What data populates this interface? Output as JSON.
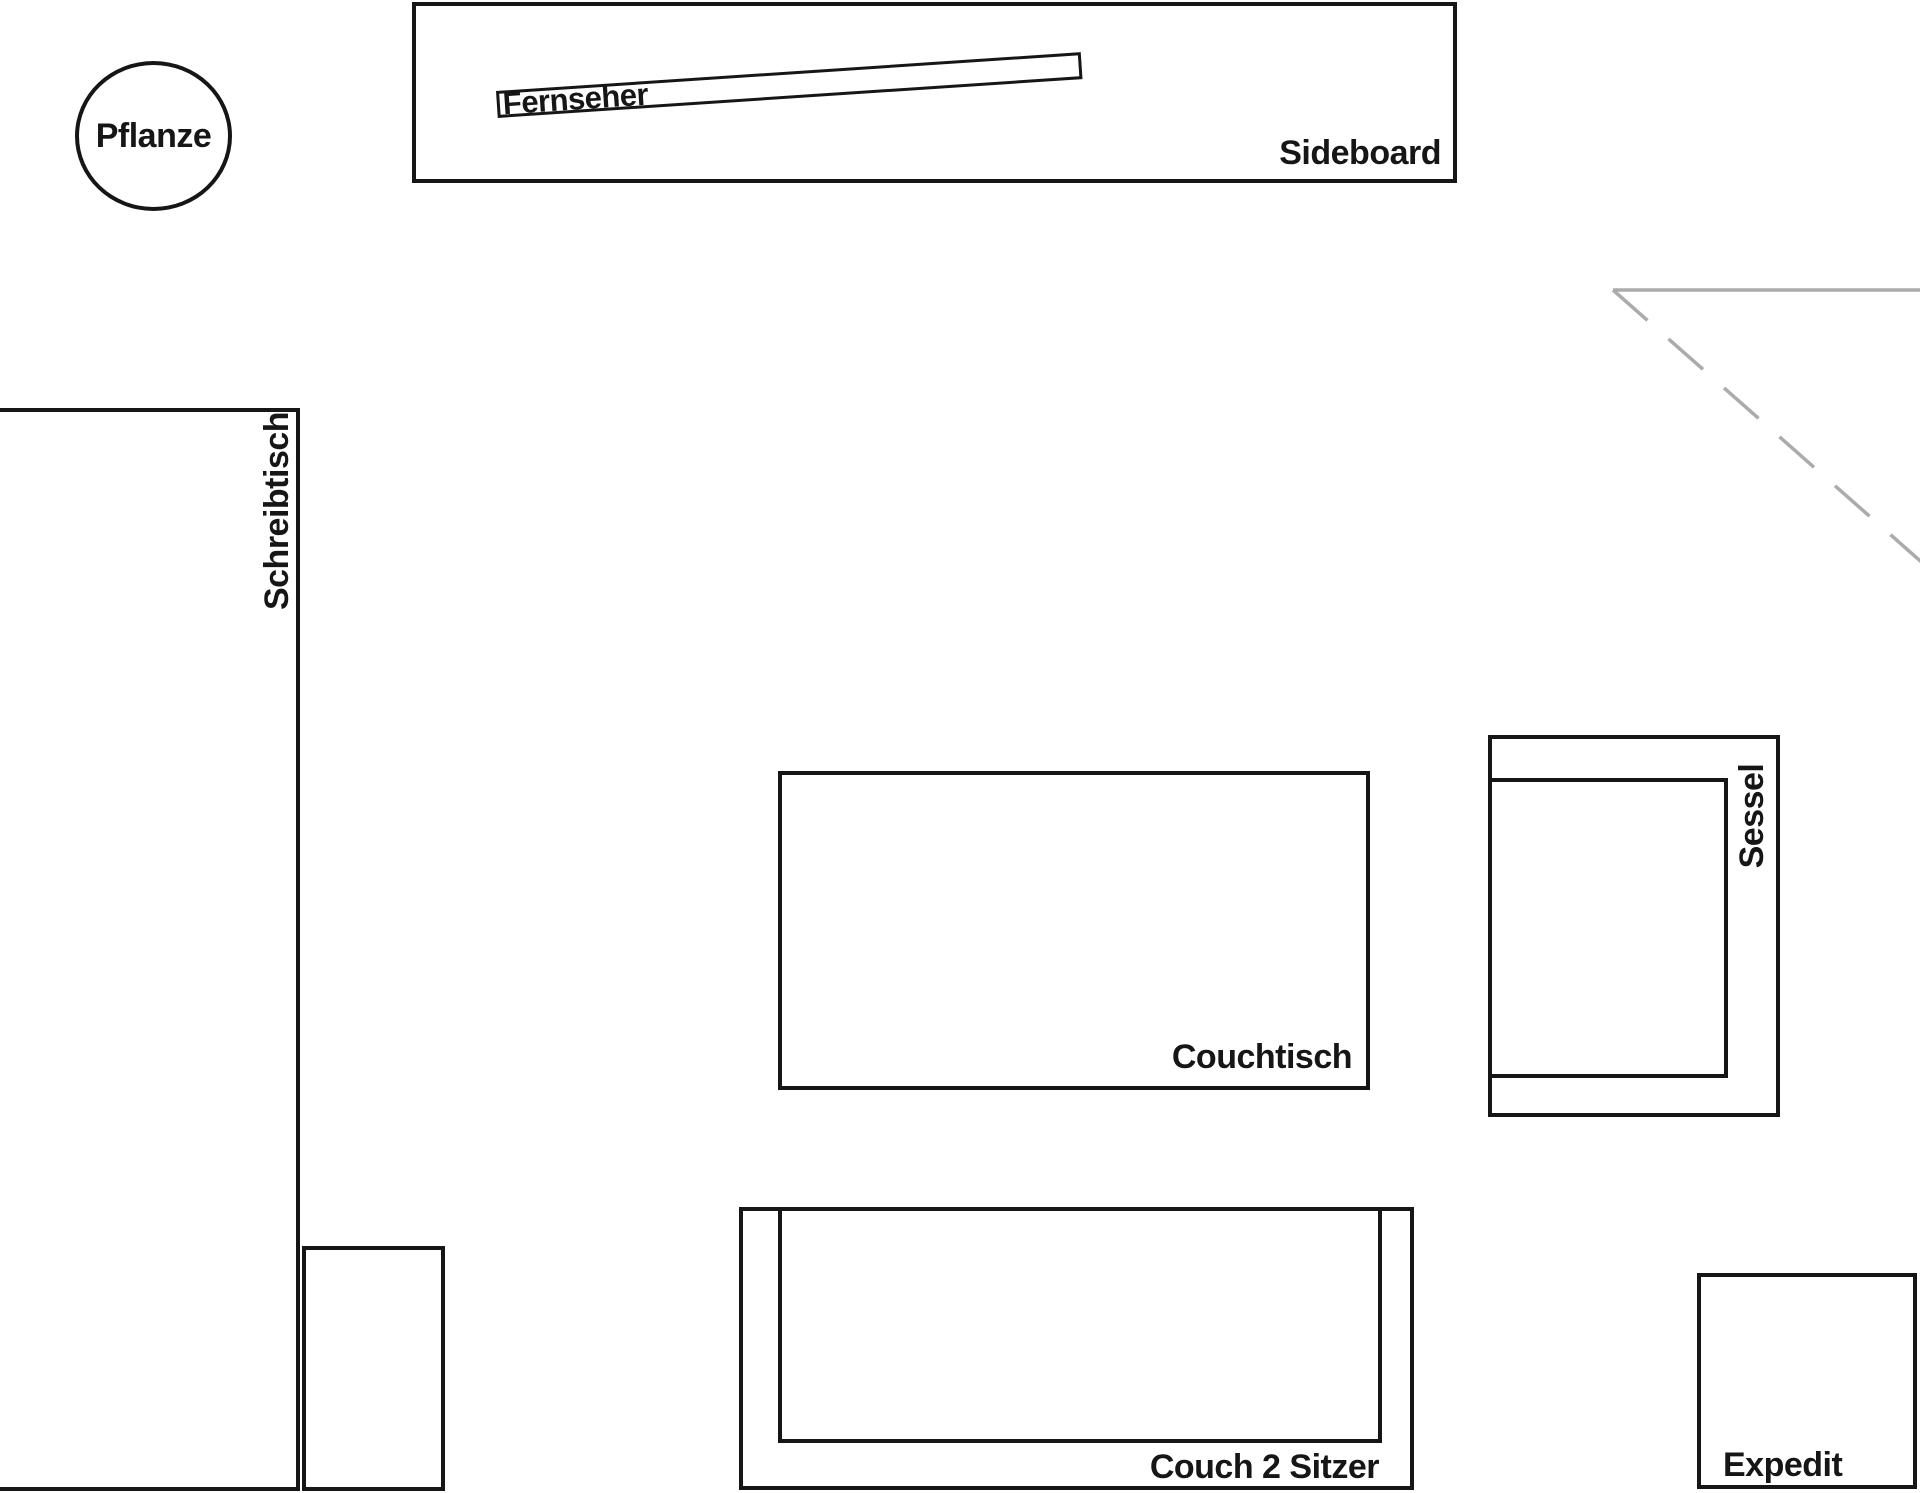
{
  "app": {
    "type": "room-floor-plan",
    "background_color": "#ffffff",
    "outline_color": "#161616",
    "guide_color": "#ababab"
  },
  "furniture": {
    "plant": {
      "label": "Pflanze"
    },
    "tv": {
      "label": "Fernseher"
    },
    "sideboard": {
      "label": "Sideboard"
    },
    "desk": {
      "label": "Schreibtisch"
    },
    "coffee_table": {
      "label": "Couchtisch"
    },
    "armchair": {
      "label": "Sessel"
    },
    "couch": {
      "label": "Couch 2 Sitzer"
    },
    "expedit_shelf": {
      "label": "Expedit"
    }
  }
}
